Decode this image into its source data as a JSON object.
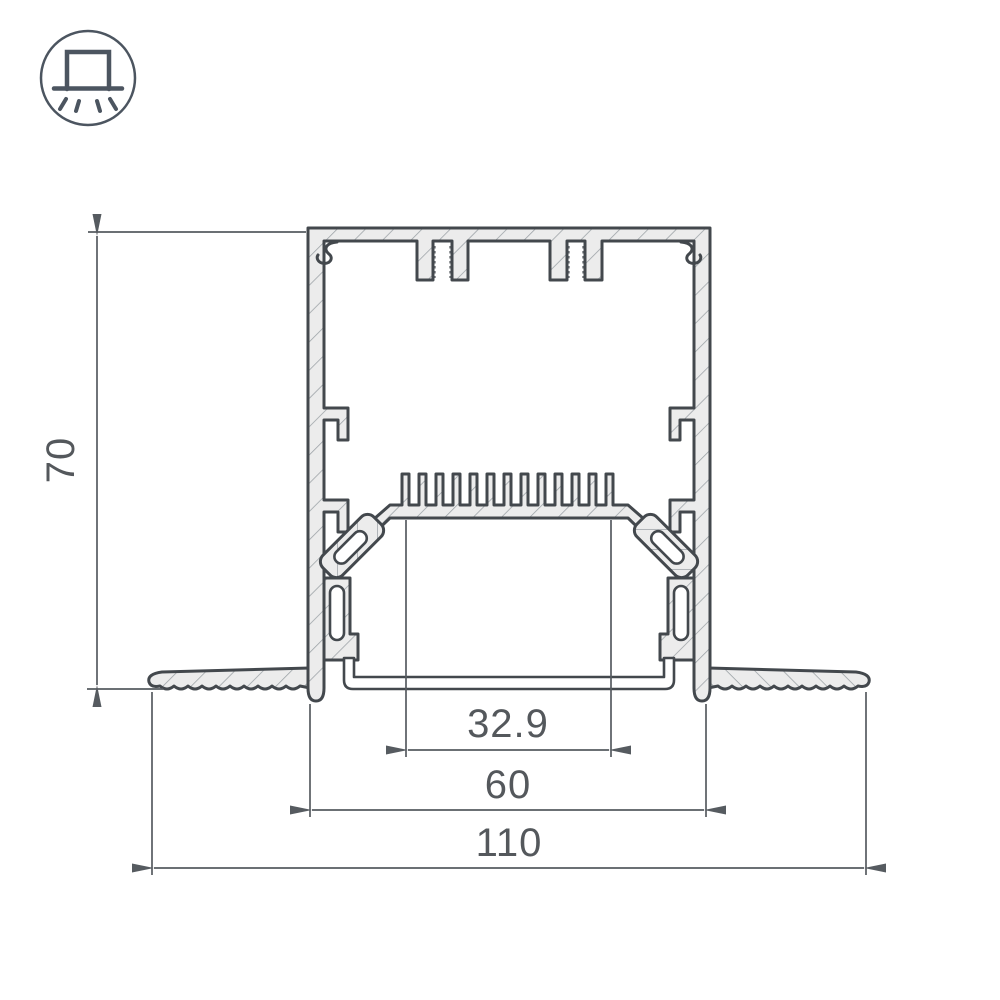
{
  "icon": {
    "name": "recessed-luminaire-symbol"
  },
  "dimensions": {
    "height": "70",
    "inner_width": "32.9",
    "body_width": "60",
    "overall_width": "110"
  },
  "colors": {
    "outline": "#43484d",
    "dimension": "#565b60",
    "profile_fill": "#ececec",
    "hatch_line": "#9aa0a5",
    "background": "#ffffff"
  }
}
